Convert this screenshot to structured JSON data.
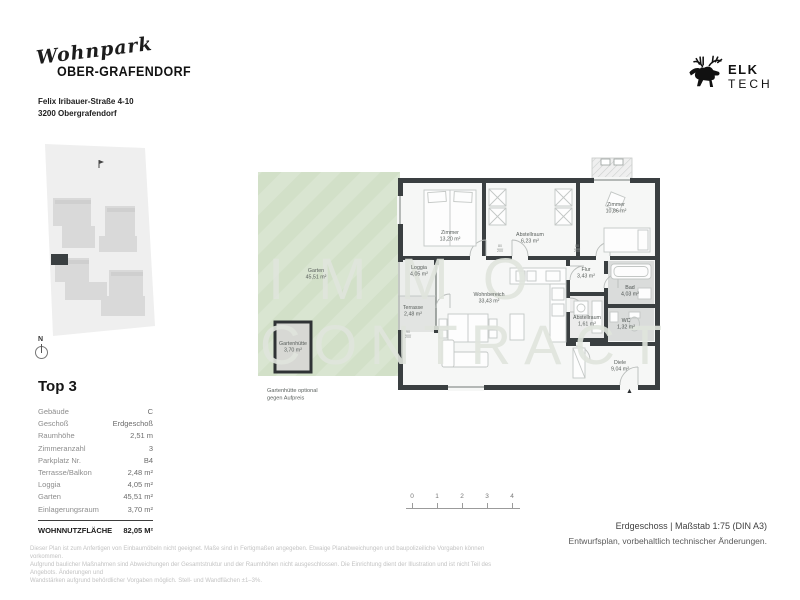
{
  "header": {
    "project_script": "Wohnpark",
    "project_name": "OBER-GRAFENDORF",
    "address_line1": "Felix Iribauer-Straße 4-10",
    "address_line2": "3200 Obergrafendorf"
  },
  "brand": {
    "elk": "ELK",
    "tech": "TECH"
  },
  "site_plan": {
    "north_label": "N"
  },
  "unit": {
    "title": "Top 3",
    "rows": [
      {
        "label": "Gebäude",
        "value": "C"
      },
      {
        "label": "Geschoß",
        "value": "Erdgeschoß"
      },
      {
        "label": "Raumhöhe",
        "value": "2,51 m"
      },
      {
        "label": "Zimmeranzahl",
        "value": "3"
      },
      {
        "label": "Parkplatz Nr.",
        "value": "B4"
      },
      {
        "label": "Terrasse/Balkon",
        "value": "2,48 m²"
      },
      {
        "label": "Loggia",
        "value": "4,05 m²"
      },
      {
        "label": "Garten",
        "value": "45,51 m²"
      },
      {
        "label": "Einlagerungsraum",
        "value": "3,70 m²"
      }
    ],
    "total_label": "WOHNNUTZFLÄCHE",
    "total_value": "82,05 M²"
  },
  "floor_plan": {
    "watermark_line1": "IMMO",
    "watermark_line2": "CONTRACT",
    "rooms": [
      {
        "name": "Zimmer",
        "area": "13,20 m²"
      },
      {
        "name": "Abstellraum",
        "area": "6,23 m²"
      },
      {
        "name": "Zimmer",
        "area": "10,86 m²"
      },
      {
        "name": "Wohnbereich",
        "area": "33,43 m²"
      },
      {
        "name": "Loggia",
        "area": "4,05 m²"
      },
      {
        "name": "Terrasse",
        "area": "2,48 m²"
      },
      {
        "name": "Flur",
        "area": "3,43 m²"
      },
      {
        "name": "Bad",
        "area": "4,03 m²"
      },
      {
        "name": "Abstellraum",
        "area": "1,61 m²"
      },
      {
        "name": "WC",
        "area": "1,32 m²"
      },
      {
        "name": "Diele",
        "area": "9,04 m²"
      },
      {
        "name": "Garten",
        "area": "45,51 m²"
      },
      {
        "name": "Gartenhütte",
        "area": "3,70 m²"
      }
    ],
    "door_tags": [
      {
        "top": "80",
        "bottom": "200"
      },
      {
        "top": "80",
        "bottom": "200"
      },
      {
        "top": "90",
        "bottom": "200"
      }
    ],
    "garden_note_line1": "Gartenhütte optional",
    "garden_note_line2": "gegen Aufpreis",
    "entry_marker": "▲"
  },
  "scale_bar": {
    "ticks": [
      "0",
      "1",
      "2",
      "3",
      "4"
    ]
  },
  "footer": {
    "right_line1": "Erdgeschoss | Maßstab 1:75 (DIN A3)",
    "right_line2": "Entwurfsplan, vorbehaltlich technischer Änderungen.",
    "disclaimer_line1": "Dieser Plan ist zum Anfertigen von Einbaumöbeln nicht geeignet. Maße sind in Fertigmaßen angegeben. Etwaige Planabweichungen und baupolizeiliche Vorgaben können vorkommen.",
    "disclaimer_line2": "Aufgrund baulicher Maßnahmen sind Abweichungen der Gesamtstruktur und der Raumhöhen nicht ausgeschlossen. Die Einrichtung dient der Illustration und ist nicht Teil des Angebots. Änderungen und",
    "disclaimer_line3": "Wandstärken aufgrund behördlicher Vorgaben möglich. Stell- und Wandflächen ±1–3%."
  },
  "colors": {
    "garden_green": "#d2e0c8",
    "wall_dark": "#3a3f41",
    "wet_room_gray": "#dadcdb",
    "watermark": "#e0e5dd"
  }
}
